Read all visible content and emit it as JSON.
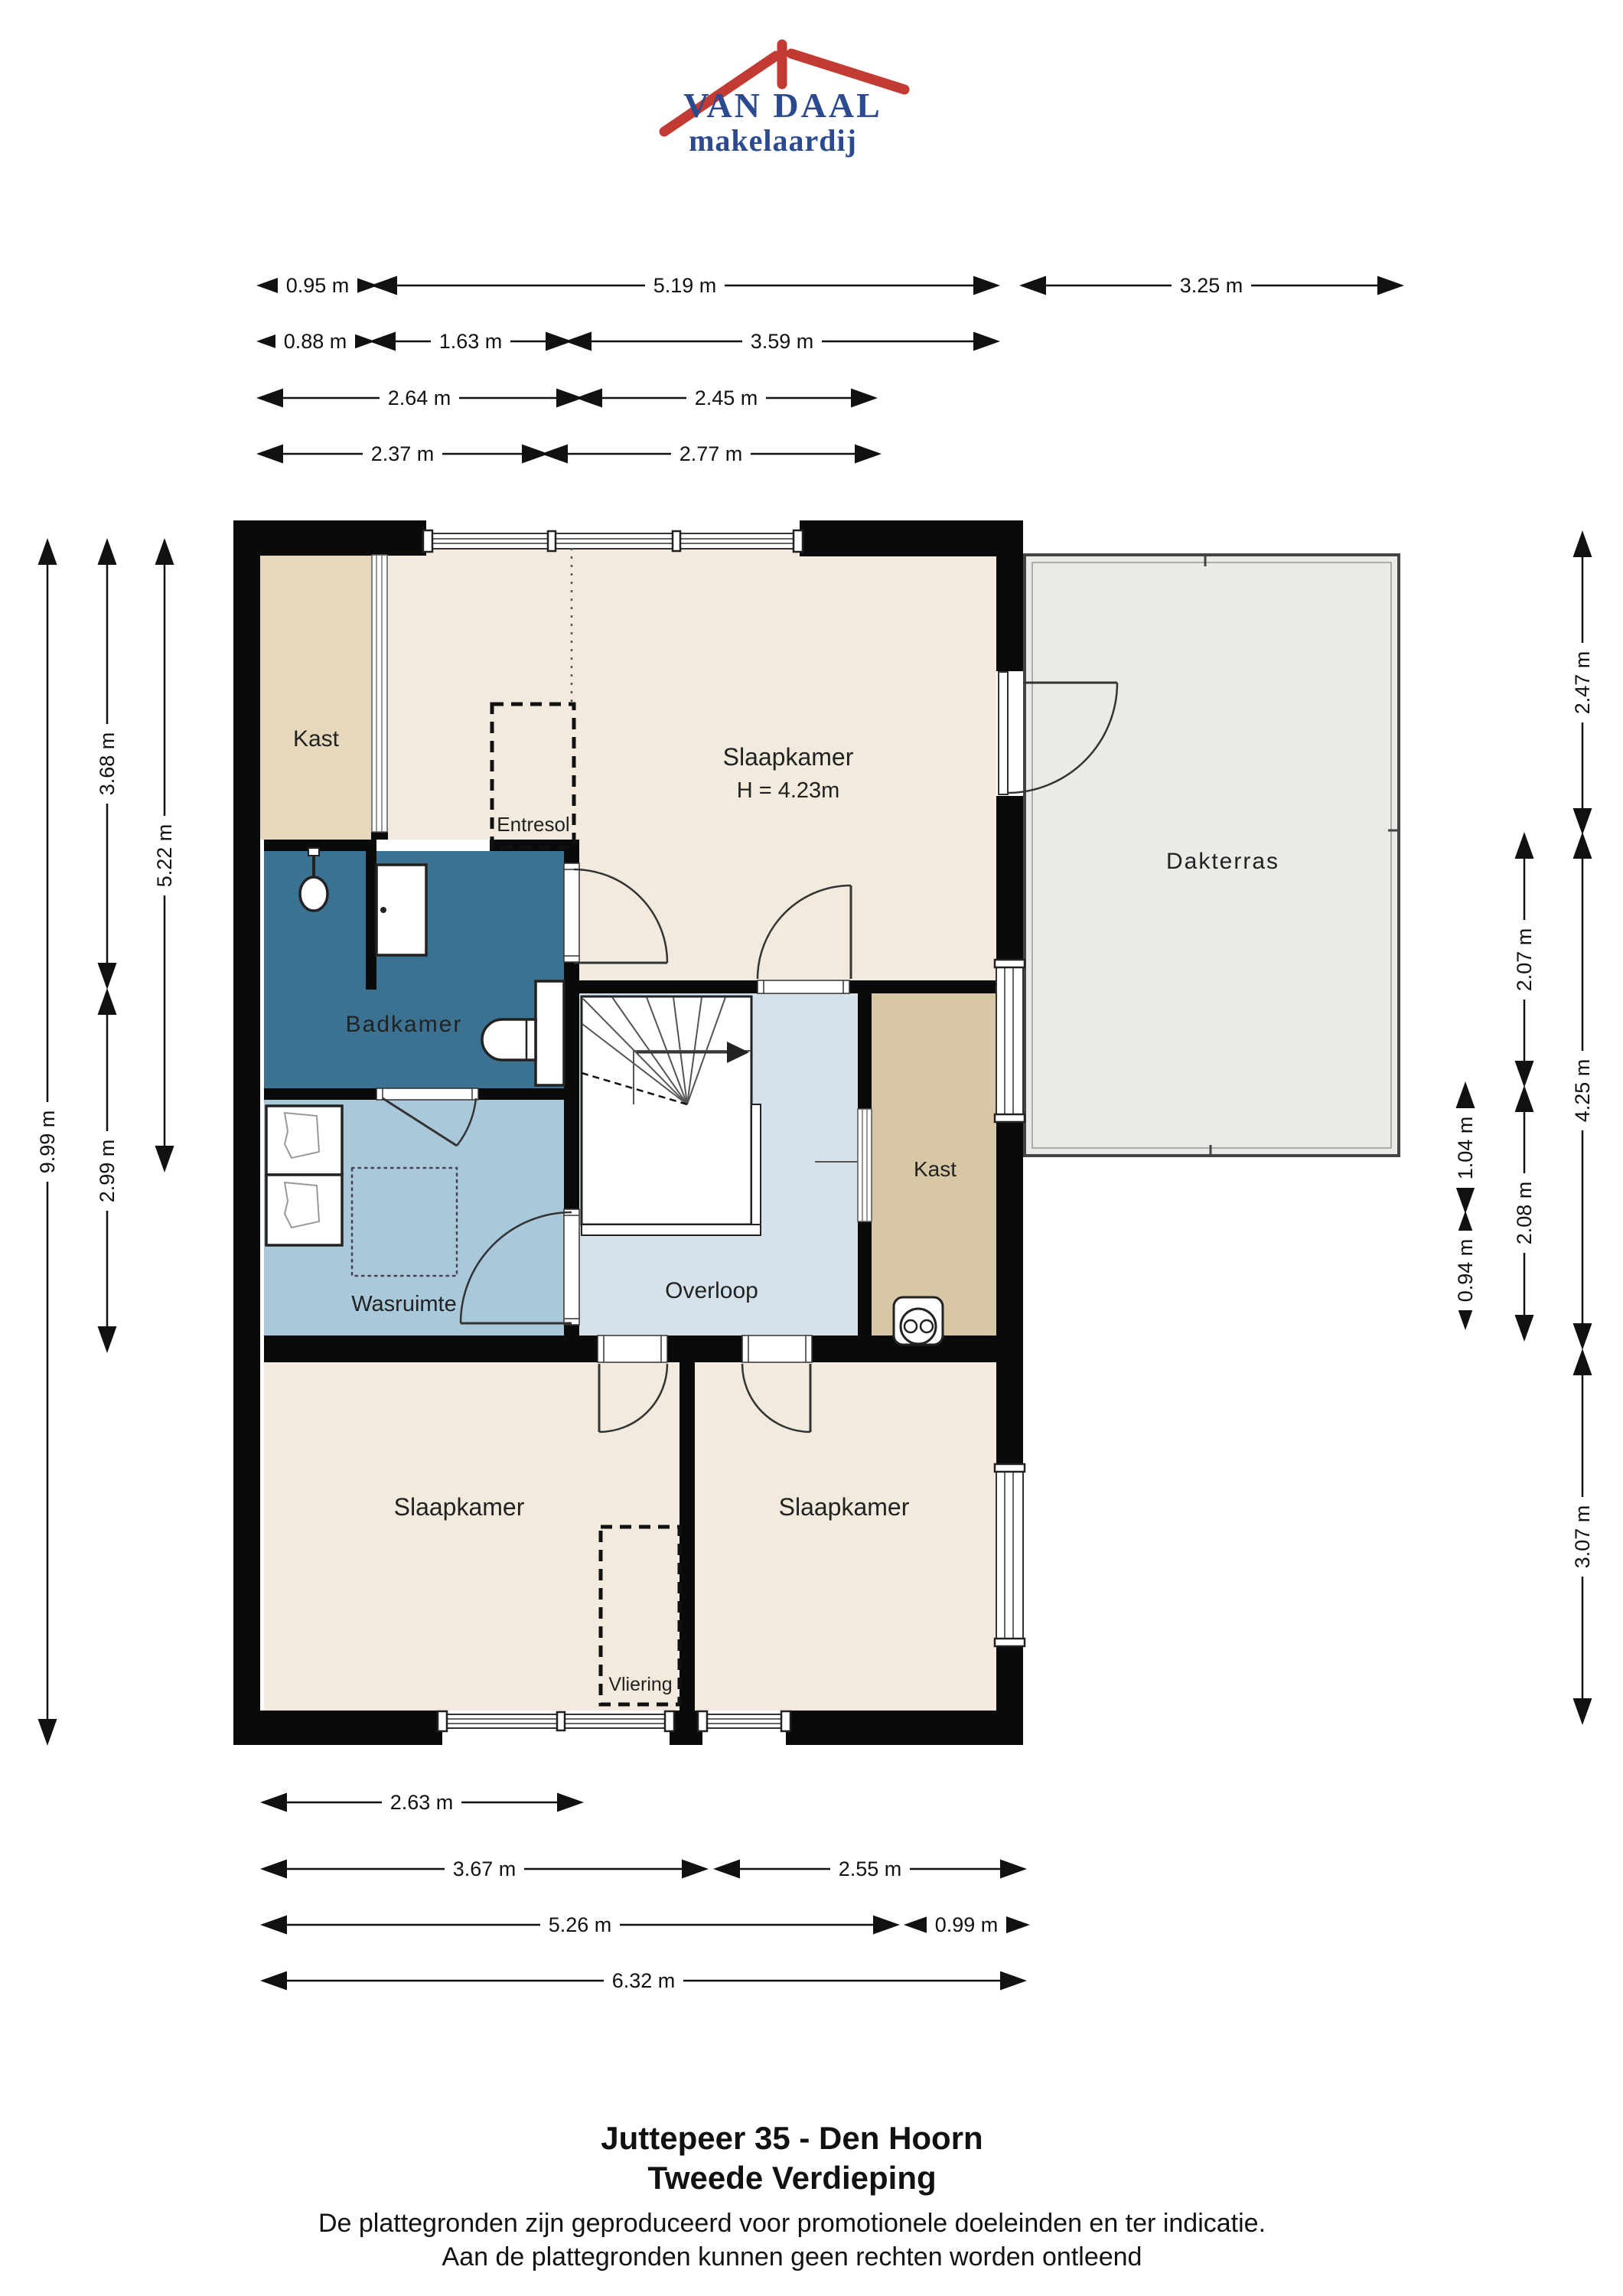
{
  "logo": {
    "name": "VAN DAAL",
    "tagline": "makelaardij",
    "brand_blue": "#2b4a8f",
    "brand_red": "#c23b33"
  },
  "rooms": {
    "kast_top": {
      "label": "Kast"
    },
    "slaapkamer_top": {
      "label": "Slaapkamer",
      "height": "H = 4.23m"
    },
    "entresol": {
      "label": "Entresol"
    },
    "dakterras": {
      "label": "Dakterras"
    },
    "badkamer": {
      "label": "Badkamer"
    },
    "wasruimte": {
      "label": "Wasruimte"
    },
    "overloop": {
      "label": "Overloop"
    },
    "kast_mid": {
      "label": "Kast"
    },
    "slaapkamer_bl": {
      "label": "Slaapkamer"
    },
    "slaapkamer_br": {
      "label": "Slaapkamer"
    },
    "vliering": {
      "label": "Vliering"
    }
  },
  "dimensions": {
    "top": [
      {
        "label": "0.95 m"
      },
      {
        "label": "5.19 m"
      },
      {
        "label": "3.25 m"
      },
      {
        "label": "0.88 m"
      },
      {
        "label": "1.63 m"
      },
      {
        "label": "3.59 m"
      },
      {
        "label": "2.64 m"
      },
      {
        "label": "2.45 m"
      },
      {
        "label": "2.37 m"
      },
      {
        "label": "2.77 m"
      }
    ],
    "bottom": [
      {
        "label": "2.63 m"
      },
      {
        "label": "3.67 m"
      },
      {
        "label": "2.55 m"
      },
      {
        "label": "5.26 m"
      },
      {
        "label": "0.99 m"
      },
      {
        "label": "6.32 m"
      }
    ],
    "left": [
      {
        "label": "9.99 m"
      },
      {
        "label": "3.68 m"
      },
      {
        "label": "2.99 m"
      },
      {
        "label": "5.22 m"
      }
    ],
    "right": [
      {
        "label": "2.47 m"
      },
      {
        "label": "2.07 m"
      },
      {
        "label": "4.25 m"
      },
      {
        "label": "1.04 m"
      },
      {
        "label": "0.94 m"
      },
      {
        "label": "2.08 m"
      },
      {
        "label": "3.07 m"
      }
    ]
  },
  "footer": {
    "title": "Juttepeer 35 - Den Hoorn",
    "subtitle": "Tweede Verdieping",
    "disclaimer1": "De plattegronden zijn geproduceerd voor promotionele doeleinden en ter indicatie.",
    "disclaimer2": "Aan de plattegronden kunnen geen rechten worden ontleend"
  },
  "colors": {
    "wall": "#0a0a0a",
    "cream": "#f2ebdd",
    "kast_top": "#e5d8bc",
    "kast_mid": "#d8c7a4",
    "badkamer": "#3b7292",
    "wasruimte": "#a9c8da",
    "overloop": "#d5e2e9",
    "dakterras": "#e9ebe6"
  }
}
